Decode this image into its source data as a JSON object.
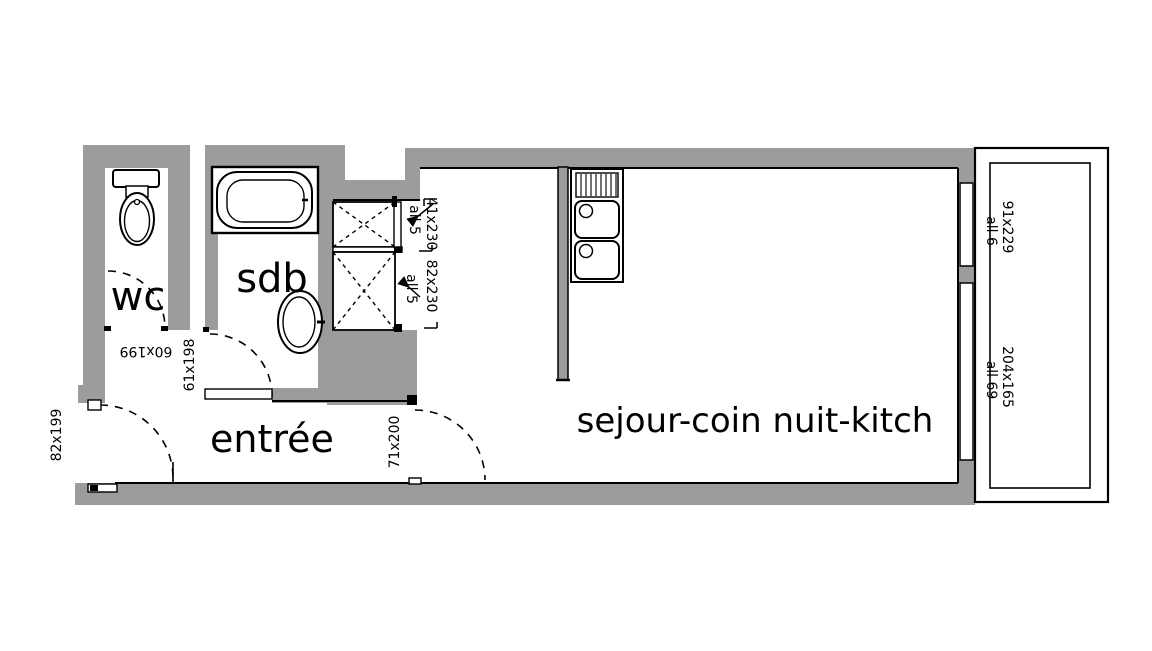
{
  "colors": {
    "wall-color": "#9c9c9c",
    "line-color": "#000000",
    "bg-color": "#ffffff"
  },
  "rooms": {
    "wc": {
      "label": "wc"
    },
    "sdb": {
      "label": "sdb"
    },
    "entree": {
      "label": "entrée"
    },
    "sejour": {
      "label": "sejour-coin nuit-kitch"
    }
  },
  "dimensions": {
    "entry_door": "82x199",
    "wc_door": "60x199",
    "sdb_door": "61x198",
    "sejour_door": "71x200",
    "closet_small": "41x230",
    "closet_small_sill": "all 5",
    "closet_large": "82x230",
    "closet_large_sill": "all 5",
    "window_top": "91x229",
    "window_top_sill": "all 6",
    "window_bottom": "204x165",
    "window_bottom_sill": "all 69"
  },
  "fixtures": {
    "toilet": "toilet",
    "bathtub": "bathtub",
    "washbasin": "washbasin",
    "kitchen_sink": "double kitchen sink",
    "closets": "crossed closets",
    "balcony": "balcony"
  }
}
